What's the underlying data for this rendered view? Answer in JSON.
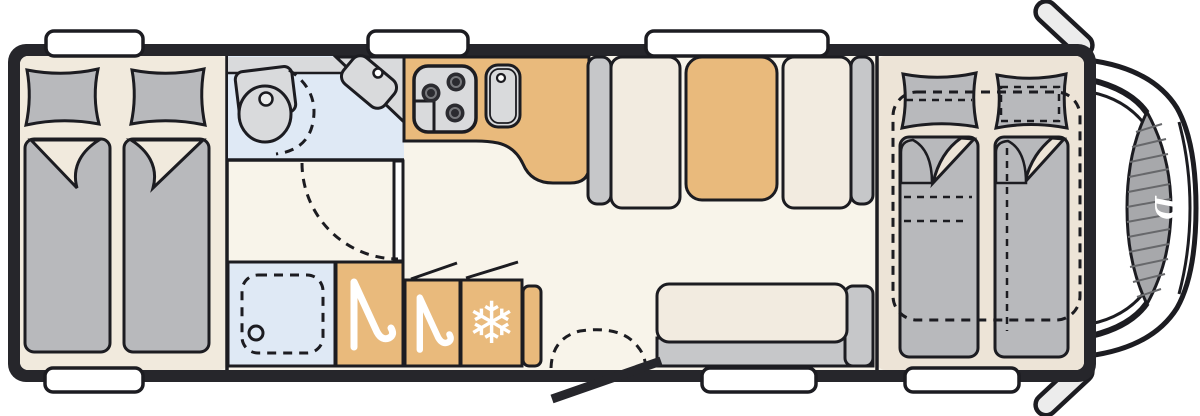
{
  "meta": {
    "title": "Motorhome floor plan (top view)",
    "vehicle_front_side": "right",
    "diagram_type": "vehicle-floorplan"
  },
  "branding": {
    "windshield_logo": "D"
  },
  "icons": {
    "snowflake_glyph": "❄",
    "hanger": "clothes-hanger",
    "snowflake": "refrigerator-freezer"
  },
  "zones": {
    "rear_bedroom": "twin single beds with pillows and duvets",
    "washroom": "swivel toilet and corner basin",
    "shower": "shower cubicle with drain",
    "wardrobe_left": "wardrobe with hanger symbol",
    "wardrobe_right": "wardrobe with hanger symbol",
    "fridge": "refrigerator with snowflake symbol",
    "kitchen": "kitchen block with 3-burner hob and sink",
    "dinette": "two facing bench seats with table",
    "side_bench": "sofa bench on door wall",
    "entry": "entry door with step",
    "front_bedroom": "front beds with drop-down bed shown dashed",
    "cab": "driver cab with windshield and mirrors"
  },
  "counts": {
    "windows_top": 3,
    "windows_bottom": 3,
    "burners": 3,
    "beds_rear": 2,
    "beds_front": 2
  },
  "colors": {
    "wall": "#26262b",
    "outline": "#1c1c21",
    "floor": "#f8f4ea",
    "floor-bedroom-rear": "#f1eadd",
    "floor-bedroom-front": "#ede4d7",
    "tan": "#e9ba7c",
    "furniture-gray": "#b8b9bc",
    "seat-gray": "#c6c7c9",
    "appliance-gray": "#d9dadc",
    "wet-blue": "#dfe9f5",
    "cushion": "#f2ebe0",
    "windshield": "#a7a8ab",
    "mirror-gray": "#ececec"
  }
}
